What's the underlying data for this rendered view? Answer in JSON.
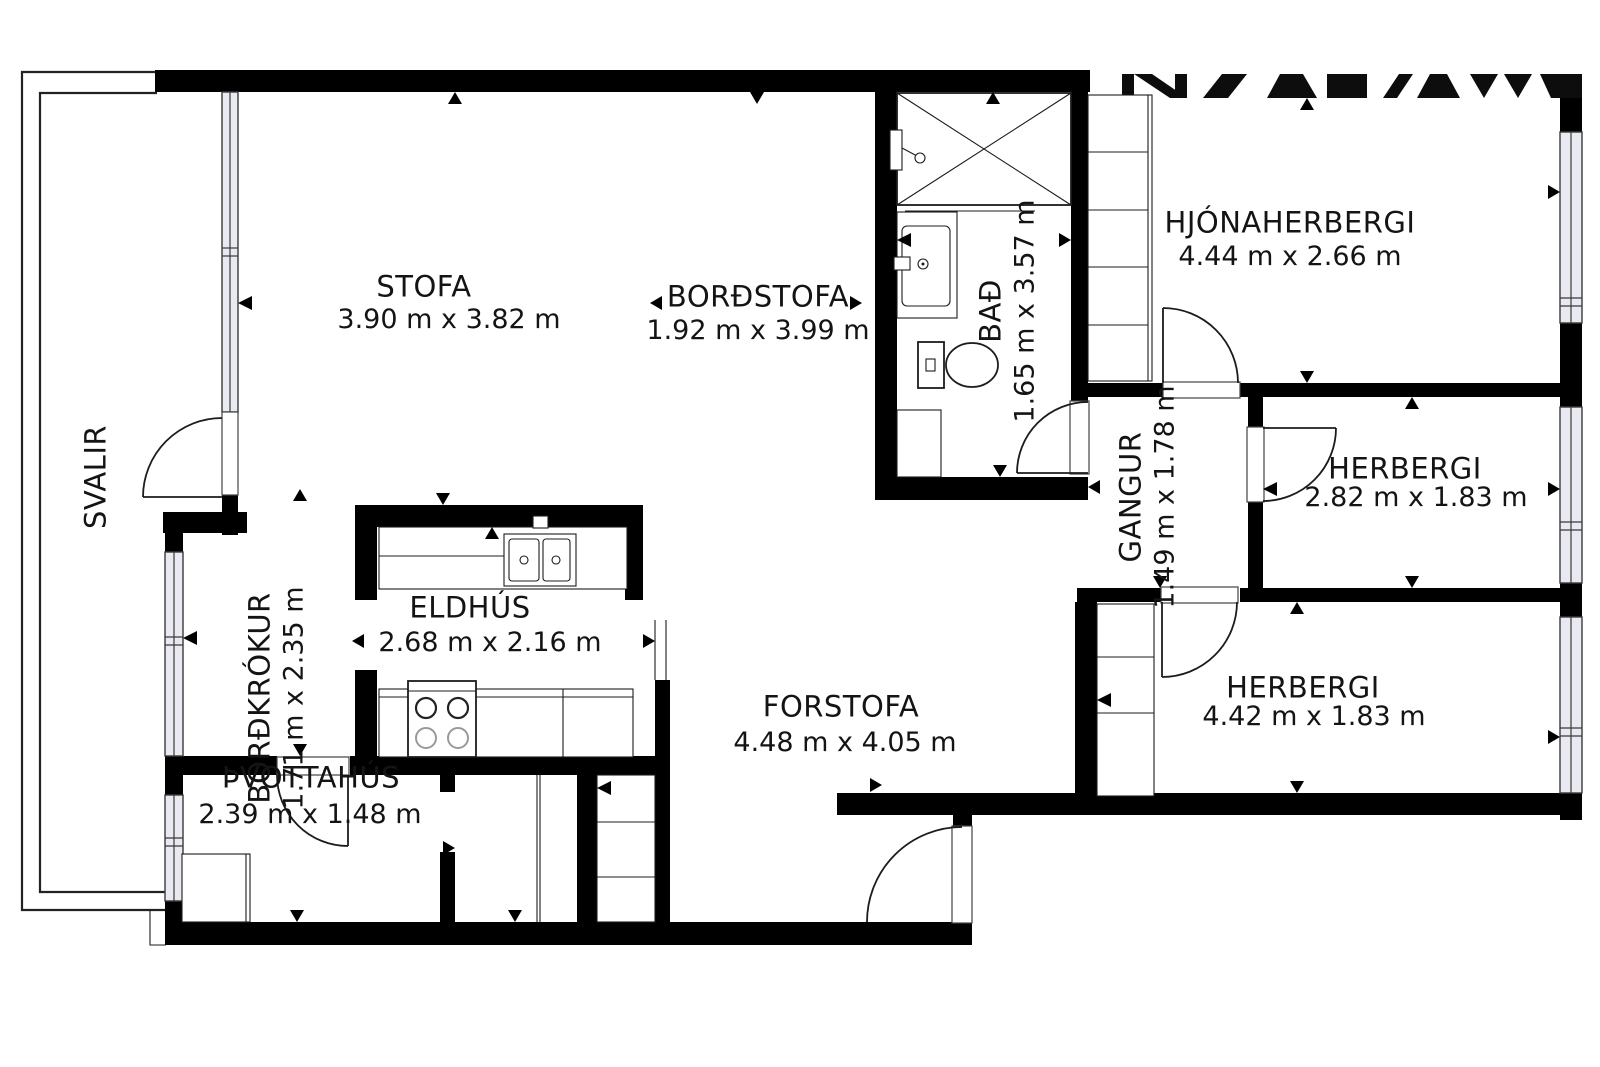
{
  "plan": {
    "colors": {
      "wall": "#000000",
      "window_fill": "#e9e9f2",
      "text": "#141414",
      "background": "#ffffff"
    },
    "rooms": {
      "stofa": {
        "name": "STOFA",
        "dims": "3.90 m x 3.82 m"
      },
      "bordstofa": {
        "name": "BORÐSTOFA",
        "dims": "1.92 m x 3.99 m"
      },
      "bad": {
        "name": "BAÐ",
        "dims": "1.65 m x 3.57 m"
      },
      "hjonaherbergi": {
        "name": "HJÓNAHERBERGI",
        "dims": "4.44 m x 2.66 m"
      },
      "herbergi_small": {
        "name": "HERBERGI",
        "dims": "2.82 m x 1.83 m"
      },
      "herbergi_large": {
        "name": "HERBERGI",
        "dims": "4.42 m x 1.83 m"
      },
      "gangur": {
        "name": "GANGUR",
        "dims": "1.49 m x 1.78 m"
      },
      "forstofa": {
        "name": "FORSTOFA",
        "dims": "4.48 m x 4.05 m"
      },
      "eldhus": {
        "name": "ELDHÚS",
        "dims": "2.68 m x 2.16 m"
      },
      "bordkrokur": {
        "name": "BORÐKRÓKUR",
        "dims": "1.71 m x 2.35 m"
      },
      "thvottahus": {
        "name": "ÞVOTTAHÚS",
        "dims": "2.39 m x 1.48 m"
      },
      "svalir": {
        "name": "SVALIR"
      }
    }
  }
}
